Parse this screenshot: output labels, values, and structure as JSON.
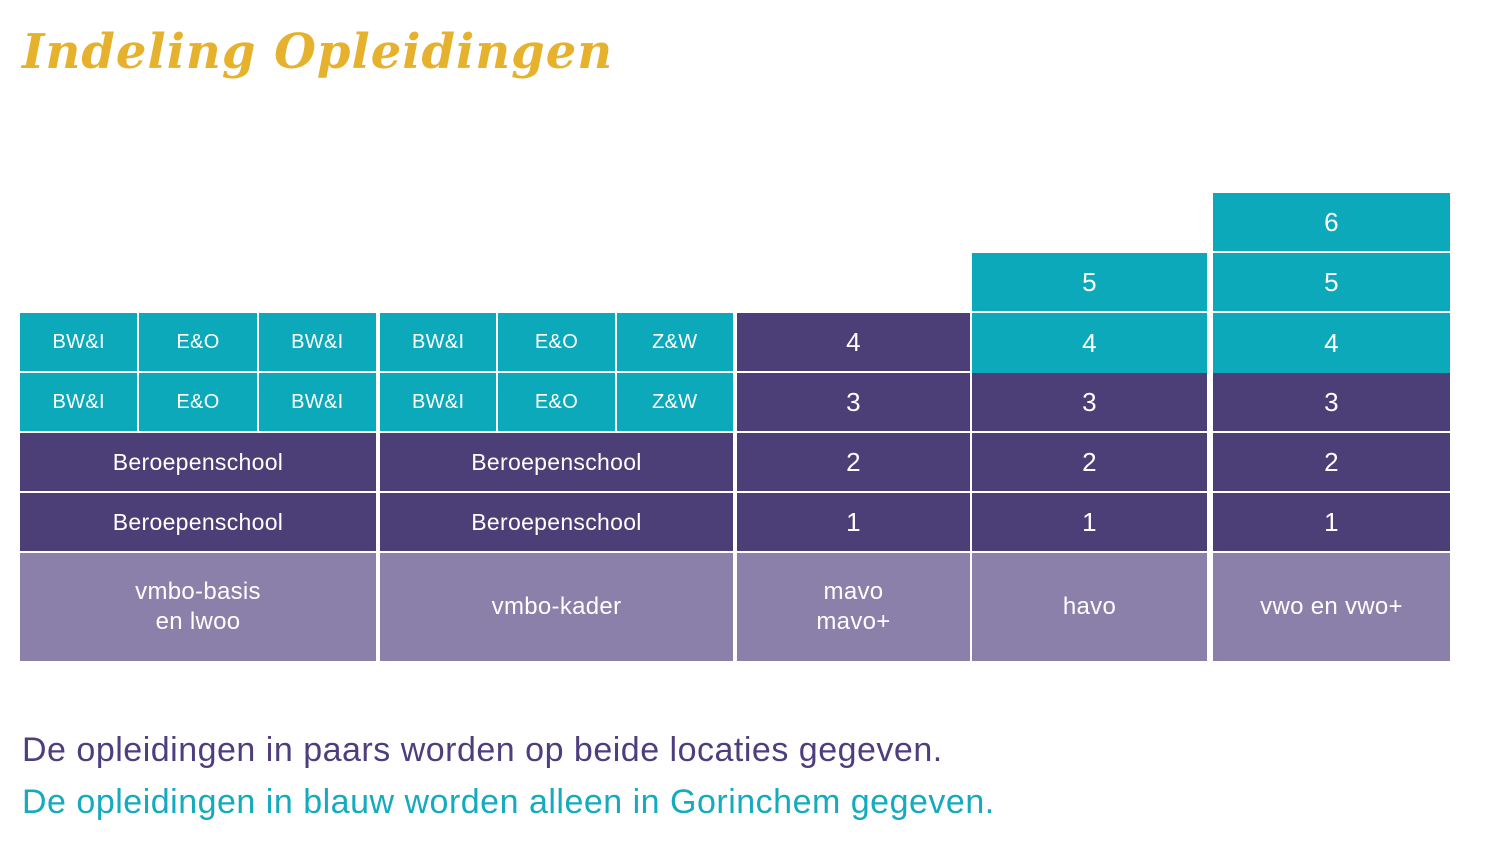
{
  "title": "Indeling Opleidingen",
  "colors": {
    "teal": "#0ca9bb",
    "purple": "#4c3f78",
    "light_purple": "#8a80a9",
    "title_gold": "#e6b22d",
    "note_purple": "#4f3e7e",
    "note_teal": "#14aabf"
  },
  "table": {
    "vmbo_basis": {
      "level4": [
        "BW&I",
        "E&O",
        "BW&I"
      ],
      "level3": [
        "BW&I",
        "E&O",
        "BW&I"
      ],
      "level2": "Beroepenschool",
      "level1": "Beroepenschool",
      "footer_line1": "vmbo-basis",
      "footer_line2": "en lwoo"
    },
    "vmbo_kader": {
      "level4": [
        "BW&I",
        "E&O",
        "Z&W"
      ],
      "level3": [
        "BW&I",
        "E&O",
        "Z&W"
      ],
      "level2": "Beroepenschool",
      "level1": "Beroepenschool",
      "footer": "vmbo-kader"
    },
    "mavo": {
      "levels": [
        "4",
        "3",
        "2",
        "1"
      ],
      "footer_line1": "mavo",
      "footer_line2": "mavo+"
    },
    "havo": {
      "teal_levels": [
        "5",
        "4"
      ],
      "purple_levels": [
        "3",
        "2",
        "1"
      ],
      "footer": "havo"
    },
    "vwo": {
      "teal_levels": [
        "6",
        "5",
        "4"
      ],
      "purple_levels": [
        "3",
        "2",
        "1"
      ],
      "footer": "vwo en vwo+"
    }
  },
  "notes": {
    "line1": "De opleidingen in paars worden op beide locaties gegeven.",
    "line2": "De opleidingen in blauw worden alleen in Gorinchem gegeven."
  }
}
